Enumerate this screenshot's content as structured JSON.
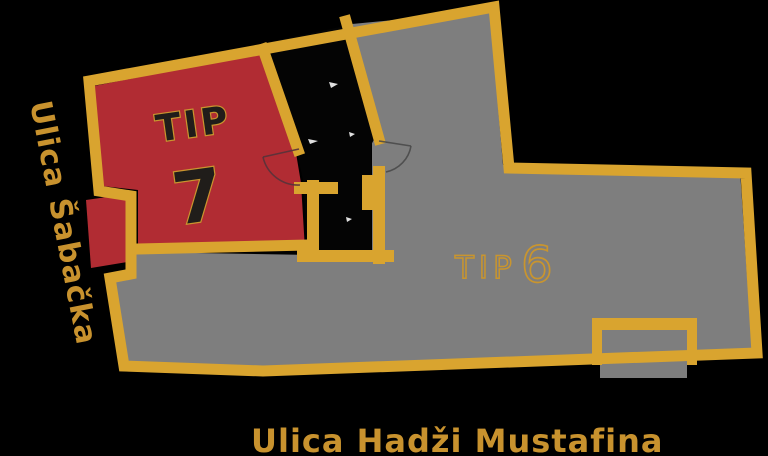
{
  "plan": {
    "background": "#000000",
    "colors": {
      "wall_gold": "#D9A42F",
      "unit7_red": "#B12C33",
      "unit6_gray": "#7E7E7E",
      "core_black": "#040404",
      "unit7_text_fill": "#201D1A",
      "label_gold_outline": "#C9952E",
      "street_text_gold": "#C8922E",
      "stair_mark_white": "#FFFFFF"
    },
    "units": [
      {
        "id": "tip-7",
        "prefix": "TIP",
        "number": "7"
      },
      {
        "id": "tip-6",
        "prefix": "TIP",
        "number": "6"
      }
    ],
    "streets": {
      "left": "Ulica Šabačka",
      "bottom": "Ulica Hadži Mustafina"
    }
  }
}
